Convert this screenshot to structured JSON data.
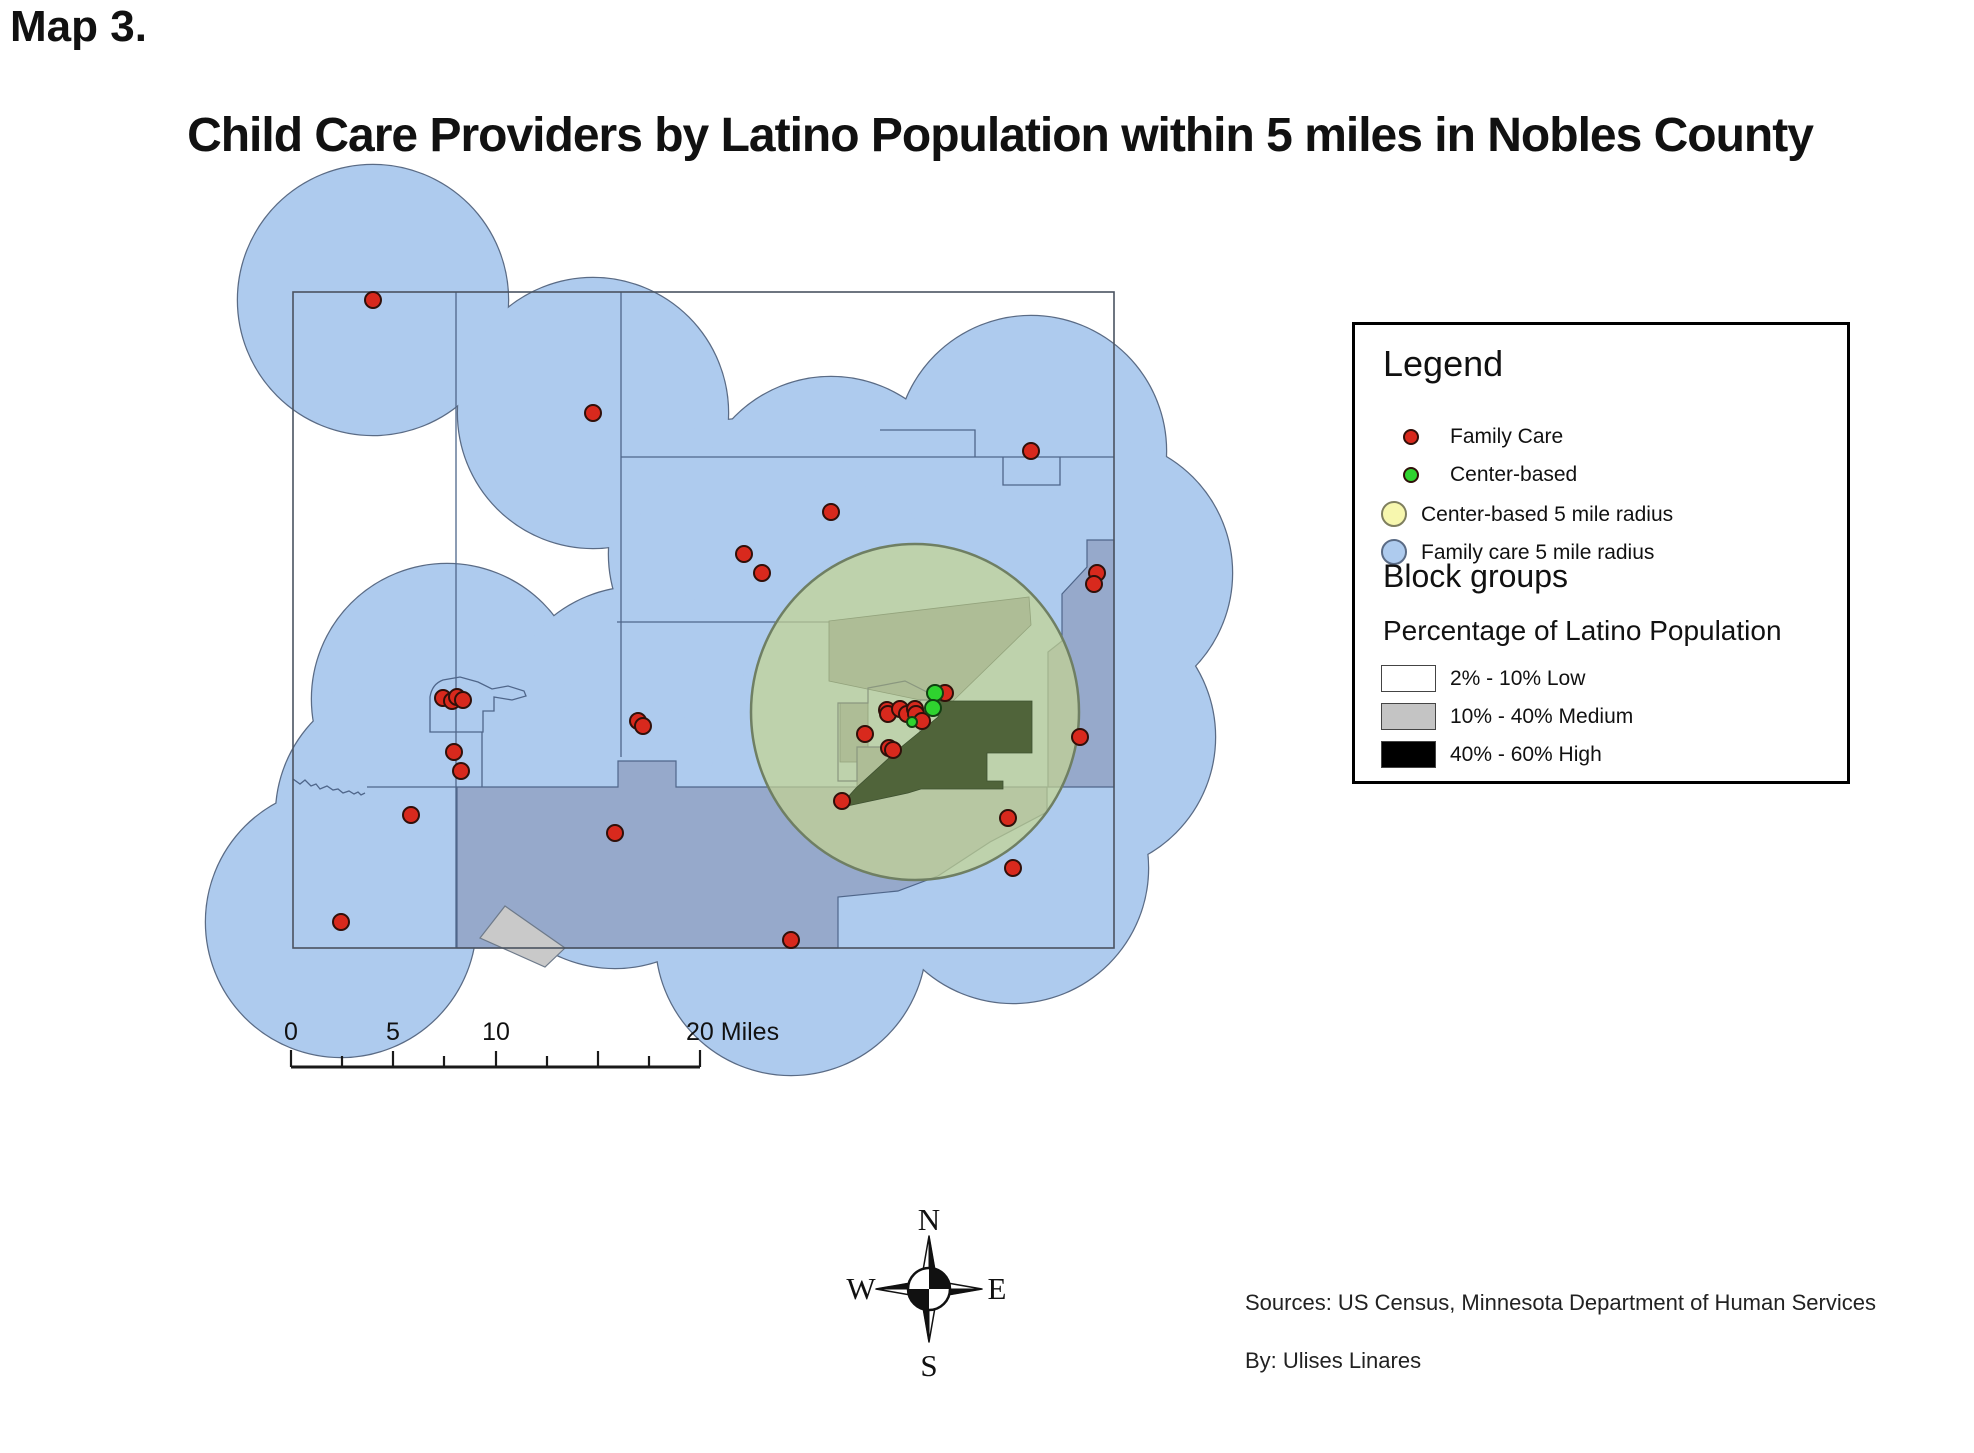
{
  "page": {
    "figure_label": "Map 3.",
    "title": "Child Care Providers by Latino Population within 5 miles in Nobles County"
  },
  "legend": {
    "title": "Legend",
    "items": [
      {
        "name": "family-care",
        "label": "Family Care",
        "color": "#D8291D"
      },
      {
        "name": "center-based",
        "label": "Center-based",
        "color": "#2FD32F"
      },
      {
        "name": "center-based-radius",
        "label": "Center-based 5 mile radius",
        "color": "#F7F7AE"
      },
      {
        "name": "family-care-radius",
        "label": "Family care 5 mile radius",
        "color": "#AECBEE"
      }
    ],
    "block_groups_title": "Block groups",
    "subtitle": "Percentage of Latino Population",
    "classes": [
      {
        "label": "2% - 10% Low",
        "color": "#FFFFFF"
      },
      {
        "label": "10% - 40% Medium",
        "color": "#C4C4C4"
      },
      {
        "label": "40% - 60% High",
        "color": "#000000"
      }
    ]
  },
  "scale_bar": {
    "labels": [
      "0",
      "5",
      "10",
      "20 Miles"
    ]
  },
  "compass": {
    "n": "N",
    "e": "E",
    "s": "S",
    "w": "W"
  },
  "credits": {
    "sources": "Sources: US Census, Minnesota Department of Human Services",
    "author": "By: Ulises Linares"
  },
  "map": {
    "colors": {
      "family_radius_fill": "#AECBEE",
      "family_radius_stroke": "#5A6B85",
      "center_radius_fill": "rgba(197,212,144,0.70)",
      "center_radius_stroke": "#6F7F63",
      "medium_under_blue": "#96A9CB",
      "medium_plain": "#C9C9C9",
      "medium_under_green": "#AEBD96",
      "high_under_green": "#50643A",
      "family_dot": "#D8291D",
      "center_dot": "#2FD32F"
    },
    "radius_px": 135,
    "radius_centers": [
      [
        373,
        300
      ],
      [
        593,
        413
      ],
      [
        831,
        512
      ],
      [
        744,
        554
      ],
      [
        762,
        573
      ],
      [
        1031,
        451
      ],
      [
        1097,
        573
      ],
      [
        447,
        699
      ],
      [
        638,
        722
      ],
      [
        454,
        752
      ],
      [
        461,
        771
      ],
      [
        411,
        815
      ],
      [
        615,
        833
      ],
      [
        341,
        922
      ],
      [
        791,
        940
      ],
      [
        842,
        801
      ],
      [
        1008,
        818
      ],
      [
        1013,
        868
      ],
      [
        1080,
        737
      ],
      [
        900,
        715
      ],
      [
        890,
        748
      ],
      [
        945,
        693
      ],
      [
        865,
        734
      ],
      [
        922,
        721
      ]
    ],
    "family_care_points": [
      [
        373,
        300
      ],
      [
        593,
        413
      ],
      [
        831,
        512
      ],
      [
        744,
        554
      ],
      [
        762,
        573
      ],
      [
        1031,
        451
      ],
      [
        1097,
        573
      ],
      [
        1094,
        584
      ],
      [
        443,
        698
      ],
      [
        452,
        701
      ],
      [
        457,
        697
      ],
      [
        463,
        700
      ],
      [
        638,
        721
      ],
      [
        643,
        726
      ],
      [
        454,
        752
      ],
      [
        461,
        771
      ],
      [
        411,
        815
      ],
      [
        615,
        833
      ],
      [
        341,
        922
      ],
      [
        791,
        940
      ],
      [
        842,
        801
      ],
      [
        1008,
        818
      ],
      [
        1013,
        868
      ],
      [
        1080,
        737
      ],
      [
        887,
        710
      ],
      [
        888,
        714
      ],
      [
        900,
        709
      ],
      [
        907,
        714
      ],
      [
        915,
        709
      ],
      [
        916,
        714
      ],
      [
        922,
        721
      ],
      [
        865,
        734
      ],
      [
        889,
        748
      ],
      [
        893,
        750
      ],
      [
        945,
        693
      ]
    ],
    "center_based_points": [
      [
        935,
        693,
        8
      ],
      [
        933,
        708,
        8
      ],
      [
        912,
        722,
        5
      ]
    ]
  }
}
